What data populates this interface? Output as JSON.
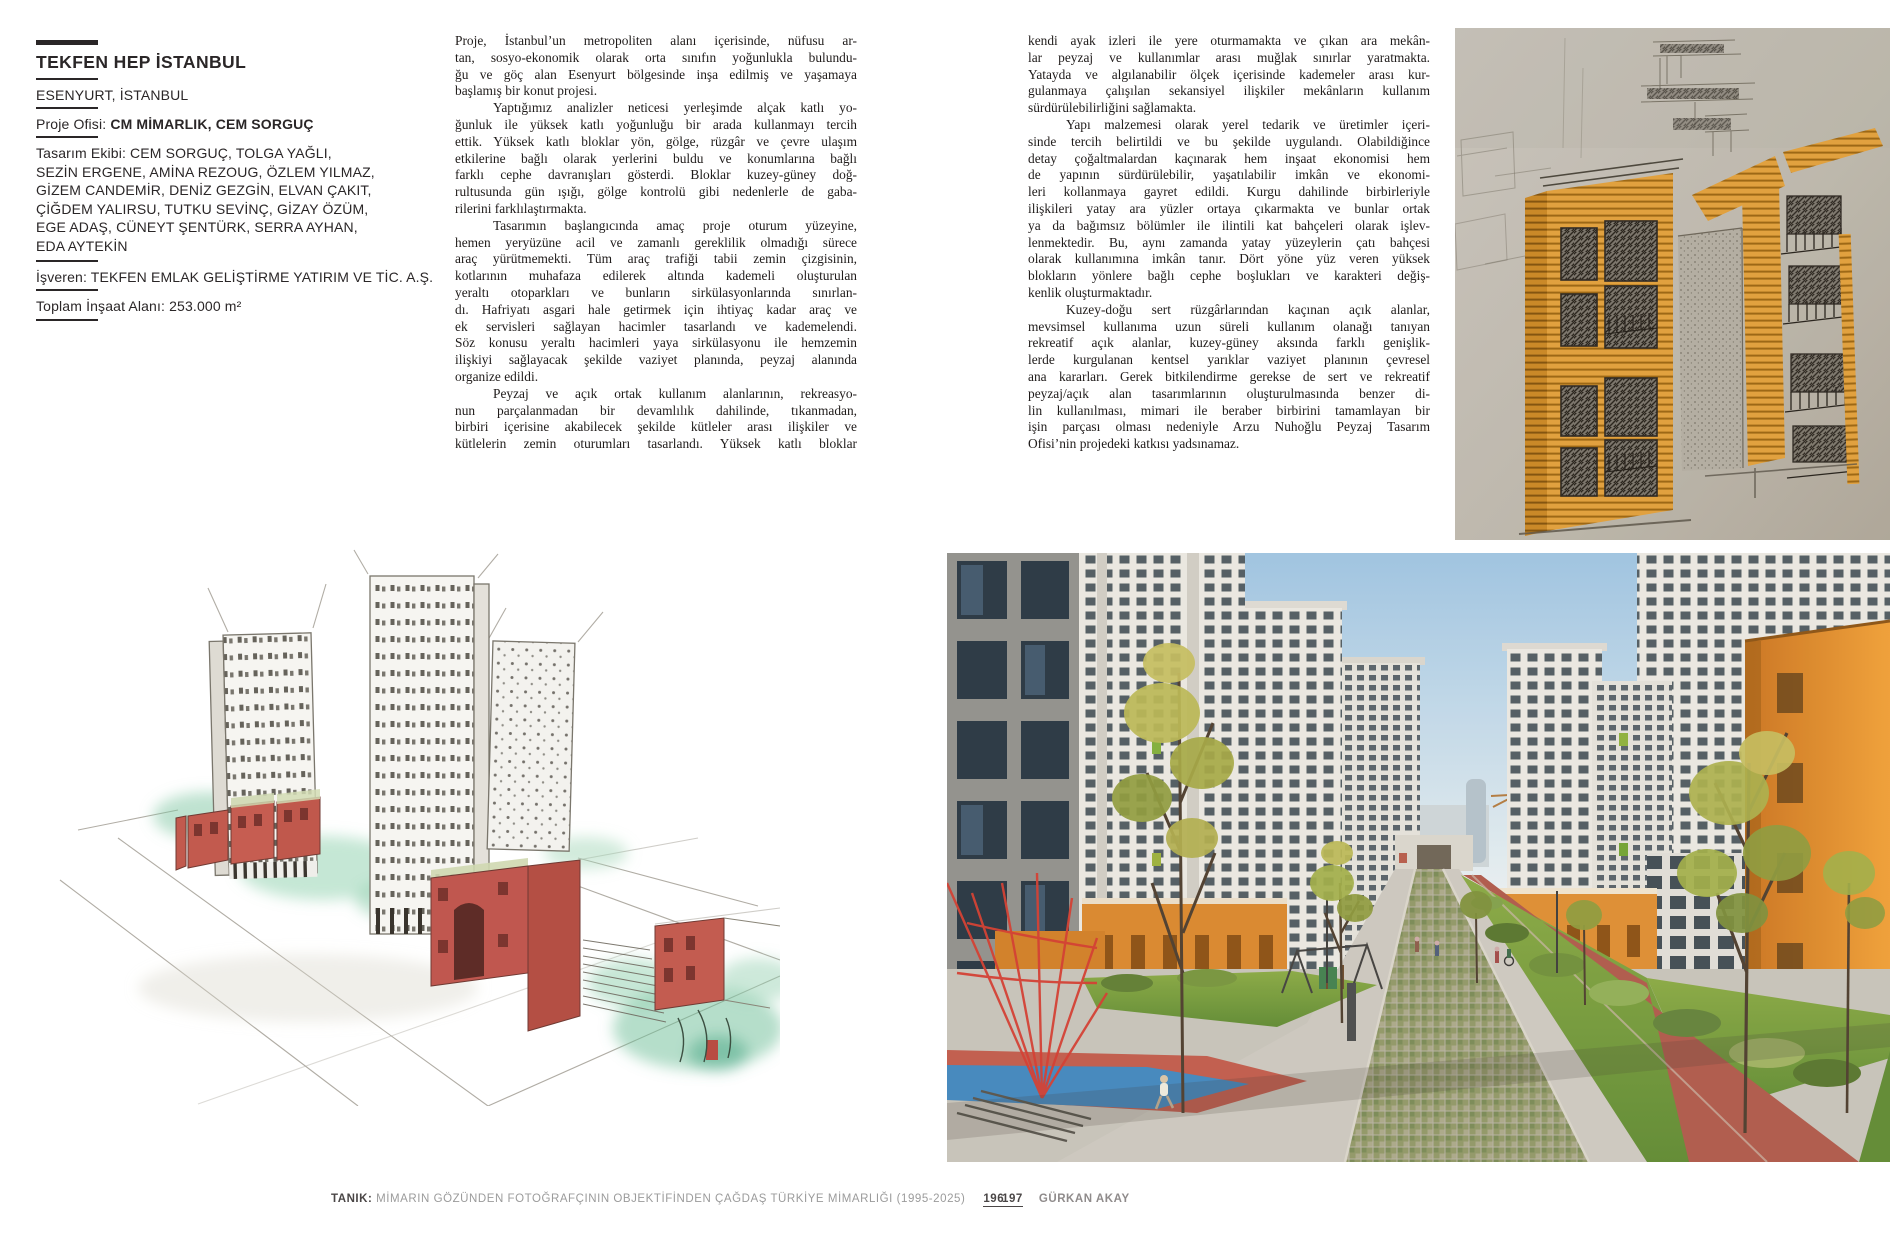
{
  "project": {
    "title": "TEKFEN HEP İSTANBUL",
    "location": "ESENYURT, İSTANBUL",
    "office_label": "Proje Ofisi: ",
    "office": "CM MİMARLIK, CEM SORGUÇ",
    "team_lines": [
      "Tasarım Ekibi: CEM SORGUÇ, TOLGA YAĞLI,",
      "SEZİN ERGENE, AMİNA REZOUG, ÖZLEM YILMAZ,",
      "GİZEM CANDEMİR, DENİZ GEZGİN, ELVAN ÇAKIT,",
      "ÇİĞDEM YALIRSU, TUTKU SEVİNÇ, GİZAY ÖZÜM,",
      "EGE ADAŞ, CÜNEYT ŞENTÜRK, SERRA AYHAN,",
      "EDA AYTEKİN"
    ],
    "client": "İşveren: TEKFEN EMLAK GELİŞTİRME YATIRIM VE TİC. A.Ş.",
    "area": "Toplam İnşaat Alanı: 253.000 m²"
  },
  "article": {
    "columns": [
      {
        "paragraphs": [
          {
            "indent": false,
            "runover": false,
            "lines": [
              "Proje, İstanbul’un metropoliten alanı içerisinde, nüfusu ar-",
              "tan, sosyo-ekonomik olarak orta sınıfın yoğunlukla bulundu-",
              "ğu ve göç alan Esenyurt bölgesinde inşa edilmiş ve yaşamaya",
              "başlamış bir konut projesi."
            ]
          },
          {
            "indent": true,
            "runover": false,
            "lines": [
              "Yaptığımız analizler neticesi yerleşimde alçak katlı yo-",
              "ğunluk ile yüksek katlı yoğunluğu bir arada kullanmayı tercih",
              "ettik. Yüksek katlı bloklar yön, gölge, rüzgâr ve çevre ulaşım",
              "etkilerine bağlı olarak yerlerini buldu ve konumlarına bağlı",
              "farklı cephe davranışları gösterdi. Bloklar kuzey-güney doğ-",
              "rultusunda gün ışığı, gölge kontrolü gibi nedenlerle de gaba-",
              "rilerini farklılaştırmakta."
            ]
          },
          {
            "indent": true,
            "runover": false,
            "lines": [
              "Tasarımın başlangıcında amaç proje oturum yüzeyine,",
              "hemen yeryüzüne acil ve zamanlı gereklilik olmadığı sürece",
              "araç yürütmemekti. Tüm araç trafiği tabii zemin çizgisinin,",
              "kotlarının muhafaza edilerek altında kademeli oluşturulan",
              "yeraltı otoparkları ve bunların sirkülasyonlarında sınırlan-",
              "dı. Hafriyatı asgari hale getirmek için ihtiyaç kadar araç ve",
              "ek servisleri sağlayan hacimler tasarlandı ve kademelendi.",
              "Söz konusu yeraltı hacimleri yaya sirkülasyonu ile hemzemin",
              "ilişkiyi sağlayacak şekilde vaziyet planında, peyzaj alanında",
              "organize edildi."
            ]
          },
          {
            "indent": true,
            "runover": true,
            "lines": [
              "Peyzaj ve açık ortak kullanım alanlarının, rekreasyo-",
              "nun parçalanmadan bir devamlılık dahilinde, tıkanmadan,",
              "birbiri içerisine akabilecek şekilde kütleler arası ilişkiler ve",
              "kütlelerin zemin oturumları tasarlandı. Yüksek katlı bloklar"
            ]
          }
        ]
      },
      {
        "paragraphs": [
          {
            "indent": false,
            "runover": false,
            "lines": [
              "kendi ayak izleri ile yere oturmamakta ve çıkan ara mekân-",
              "lar peyzaj ve kullanımlar arası muğlak sınırlar yaratmakta.",
              "Yatayda ve algılanabilir ölçek içerisinde kademeler arası kur-",
              "gulanmaya çalışılan sekansiyel ilişkiler mekânların kullanım",
              "sürdürülebilirliğini sağlamakta."
            ]
          },
          {
            "indent": true,
            "runover": false,
            "lines": [
              "Yapı malzemesi olarak yerel tedarik ve üretimler içeri-",
              "sinde tercih belirtildi ve bu şekilde uygulandı. Olabildiğince",
              "detay çoğaltmalardan kaçınarak hem inşaat ekonomisi hem",
              "de yapının sürdürülebilir, yaşatılabilir imkân ve ekonomi-",
              "leri kollanmaya gayret edildi. Kurgu dahilinde birbirleriyle",
              "ilişkileri yatay ara yüzler ortaya çıkarmakta ve bunlar ortak",
              "ya da bağımsız bölümler ile ilintili kat bahçeleri olarak işlev-",
              "lenmektedir. Bu, aynı zamanda yatay yüzeylerin çatı bahçesi",
              "olarak kullanımına imkân tanır. Dört yöne yüz veren yüksek",
              "blokların yönlere bağlı cephe boşlukları ve karakteri değiş-",
              "kenlik oluşturmaktadır."
            ]
          },
          {
            "indent": true,
            "runover": false,
            "lines": [
              "Kuzey-doğu sert rüzgârlarından kaçınan açık alanlar,",
              "mevsimsel kullanıma uzun süreli kullanım olanağı tanıyan",
              "rekreatif açık alanlar, kuzey-güney aksında farklı genişlik-",
              "lerde kurgulanan kentsel yarıklar vaziyet planının çevresel",
              "ana kararları. Gerek bitkilendirme gerekse de sert ve rekreatif",
              "peyzaj/açık alan tasarımlarının oluşturulmasında benzer di-",
              "lin kullanılması, mimari ile beraber birbirini tamamlayan bir",
              "işin parçası olması nedeniyle Arzu Nuhoğlu Peyzaj Tasarım",
              "Ofisi’nin projedeki katkısı yadsınamaz."
            ]
          }
        ]
      }
    ]
  },
  "figures": {
    "sketch": {
      "alt": "Orange marker hand sketch of apartment facade blocks with balconies"
    },
    "watercolor": {
      "alt": "Watercolor massing sketch of three towers with red low-rise street blocks"
    },
    "photo": {
      "alt": "Courtyard photo: white towers, orange accent blocks, lawns, central walkway, playground and red track"
    }
  },
  "footer_left": {
    "label": "TANIK:",
    "text": " MİMARIN GÖZÜNDEN FOTOĞRAFÇININ OBJEKTİFİNDEN ÇAĞDAŞ TÜRKİYE MİMARLIĞI (1995-2025)",
    "page": "196"
  },
  "footer_right": {
    "page": "197",
    "credit": "GÜRKAN AKAY"
  },
  "colors": {
    "ink": "#232021",
    "footer_gray": "#9b9b9b",
    "accent_orange": "#e2932e",
    "sketch_paper": "#c6c0b5",
    "watercolor_red": "#c2594e",
    "photo_track_red": "#ad584b",
    "playground_blue": "#3f86c0",
    "lawn_green": "#6f9a3f"
  }
}
